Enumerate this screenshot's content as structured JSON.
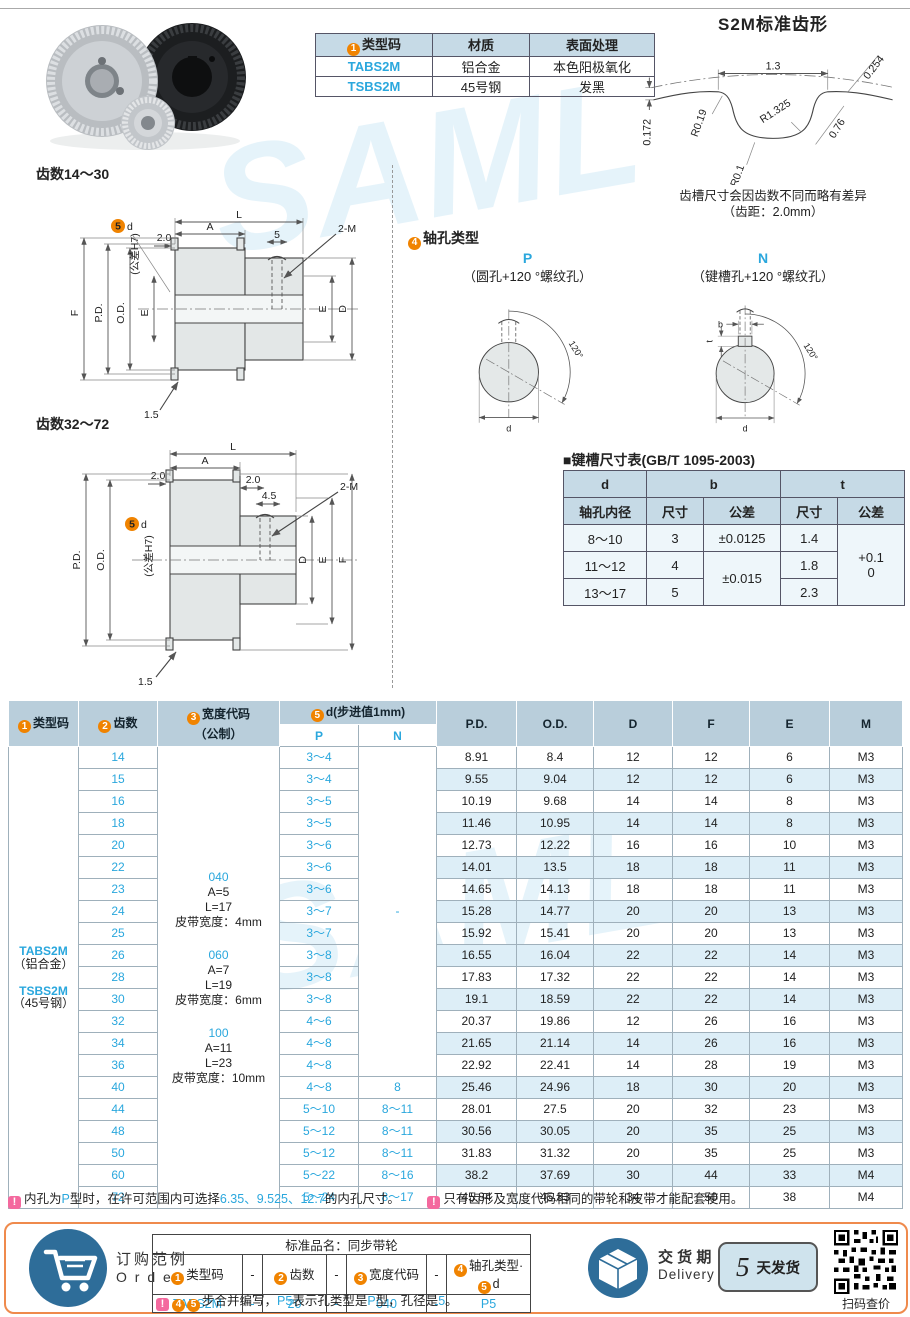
{
  "page": {
    "watermark": "SAML"
  },
  "top": {
    "type_table": {
      "badge": "1",
      "h_code": "类型码",
      "h_mat": "材质",
      "h_fin": "表面处理",
      "rows": [
        {
          "code": "TABS2M",
          "mat": "铝合金",
          "fin": "本色阳极氧化"
        },
        {
          "code": "TSBS2M",
          "mat": "45号钢",
          "fin": "发黑"
        }
      ]
    },
    "tooth_profile": {
      "title": "S2M标准齿形",
      "w": "1.3",
      "t254": "0.254",
      "r1": "R1.325",
      "r19": "R0.19",
      "f76": "0.76",
      "h172": "0.172",
      "r01": "R0.1",
      "note1": "齿槽尺寸会因齿数不同而略有差异",
      "note2": "（齿距：2.0mm）"
    }
  },
  "drawings": {
    "small": {
      "title": "齿数14～30",
      "l": "L",
      "a": "A",
      "off": "2.0",
      "s5": "5",
      "m": "2-M",
      "f": "F",
      "pd": "P.D.",
      "od": "O.D.",
      "e": "E",
      "e2": "E",
      "dd": "D",
      "fl": "1.5",
      "badge": "5",
      "d": "d",
      "tol": "(公差H7)"
    },
    "large": {
      "title": "齿数32～72",
      "l": "L",
      "a": "A",
      "off_l": "2.0",
      "off_r": "2.0",
      "s45": "4.5",
      "m": "2-M",
      "pd": "P.D.",
      "od": "O.D.",
      "dd": "D",
      "e": "E",
      "f": "F",
      "fl": "1.5",
      "badge": "5",
      "d": "d",
      "tol": "(公差H7)"
    }
  },
  "shaft_hole": {
    "badge": "4",
    "title": "轴孔类型",
    "p": {
      "label": "P",
      "desc": "（圆孔+120 °螺纹孔）",
      "angle": "120°",
      "d": "d"
    },
    "n": {
      "label": "N",
      "desc": "（键槽孔+120 °螺纹孔）",
      "angle": "120°",
      "d": "d",
      "b": "b",
      "t": "t"
    }
  },
  "keyway": {
    "title": "■键槽尺寸表(GB/T 1095-2003)",
    "h_d": "d",
    "h_d2": "轴孔内径",
    "h_b": "b",
    "h_t": "t",
    "h_size": "尺寸",
    "h_tol": "公差",
    "h_size2": "尺寸",
    "h_tol2": "公差",
    "rows": [
      {
        "d": "8～10",
        "b": "3",
        "bt": "±0.0125",
        "t": "1.4"
      },
      {
        "d": "11～12",
        "b": "4",
        "bt": "±0.015",
        "t": "1.8"
      },
      {
        "d": "13～17",
        "b": "5",
        "t": "2.3"
      }
    ],
    "t_tol1": "+0.1",
    "t_tol2": "0"
  },
  "main_table": {
    "header": {
      "b1": "1",
      "c1": "类型码",
      "b2": "2",
      "c2": "齿数",
      "b3": "3",
      "c3": "宽度代码",
      "c3b": "（公制）",
      "b5": "5",
      "c5": "d(步进值1mm)",
      "p": "P",
      "n": "N",
      "pd": "P.D.",
      "od": "O.D.",
      "d": "D",
      "f": "F",
      "e": "E",
      "m": "M"
    },
    "type_cell": {
      "code1": "TABS2M",
      "mat1": "（铝合金）",
      "code2": "TSBS2M",
      "mat2": "（45号钢）"
    },
    "width_groups": [
      {
        "code": "040",
        "a": "A=5",
        "l": "L=17",
        "belt": "皮带宽度：4mm"
      },
      {
        "code": "060",
        "a": "A=7",
        "l": "L=19",
        "belt": "皮带宽度：6mm"
      },
      {
        "code": "100",
        "a": "A=11",
        "l": "L=23",
        "belt": "皮带宽度：10mm"
      }
    ],
    "n_merged": "-",
    "rows": [
      {
        "t": "14",
        "p": "3～4",
        "pd": "8.91",
        "od": "8.4",
        "d": "12",
        "f": "12",
        "e": "6",
        "m": "M3"
      },
      {
        "t": "15",
        "p": "3～4",
        "pd": "9.55",
        "od": "9.04",
        "d": "12",
        "f": "12",
        "e": "6",
        "m": "M3"
      },
      {
        "t": "16",
        "p": "3～5",
        "pd": "10.19",
        "od": "9.68",
        "d": "14",
        "f": "14",
        "e": "8",
        "m": "M3"
      },
      {
        "t": "18",
        "p": "3～5",
        "pd": "11.46",
        "od": "10.95",
        "d": "14",
        "f": "14",
        "e": "8",
        "m": "M3"
      },
      {
        "t": "20",
        "p": "3～6",
        "pd": "12.73",
        "od": "12.22",
        "d": "16",
        "f": "16",
        "e": "10",
        "m": "M3"
      },
      {
        "t": "22",
        "p": "3～6",
        "pd": "14.01",
        "od": "13.5",
        "d": "18",
        "f": "18",
        "e": "11",
        "m": "M3"
      },
      {
        "t": "23",
        "p": "3～6",
        "pd": "14.65",
        "od": "14.13",
        "d": "18",
        "f": "18",
        "e": "11",
        "m": "M3"
      },
      {
        "t": "24",
        "p": "3～7",
        "pd": "15.28",
        "od": "14.77",
        "d": "20",
        "f": "20",
        "e": "13",
        "m": "M3"
      },
      {
        "t": "25",
        "p": "3～7",
        "pd": "15.92",
        "od": "15.41",
        "d": "20",
        "f": "20",
        "e": "13",
        "m": "M3"
      },
      {
        "t": "26",
        "p": "3～8",
        "pd": "16.55",
        "od": "16.04",
        "d": "22",
        "f": "22",
        "e": "14",
        "m": "M3"
      },
      {
        "t": "28",
        "p": "3～8",
        "pd": "17.83",
        "od": "17.32",
        "d": "22",
        "f": "22",
        "e": "14",
        "m": "M3"
      },
      {
        "t": "30",
        "p": "3～8",
        "pd": "19.1",
        "od": "18.59",
        "d": "22",
        "f": "22",
        "e": "14",
        "m": "M3"
      },
      {
        "t": "32",
        "p": "4～6",
        "pd": "20.37",
        "od": "19.86",
        "d": "12",
        "f": "26",
        "e": "16",
        "m": "M3"
      },
      {
        "t": "34",
        "p": "4～8",
        "pd": "21.65",
        "od": "21.14",
        "d": "14",
        "f": "26",
        "e": "16",
        "m": "M3"
      },
      {
        "t": "36",
        "p": "4～8",
        "pd": "22.92",
        "od": "22.41",
        "d": "14",
        "f": "28",
        "e": "19",
        "m": "M3"
      },
      {
        "t": "40",
        "p": "4～8",
        "n": "8",
        "pd": "25.46",
        "od": "24.96",
        "d": "18",
        "f": "30",
        "e": "20",
        "m": "M3"
      },
      {
        "t": "44",
        "p": "5～10",
        "n": "8～11",
        "pd": "28.01",
        "od": "27.5",
        "d": "20",
        "f": "32",
        "e": "23",
        "m": "M3"
      },
      {
        "t": "48",
        "p": "5～12",
        "n": "8～11",
        "pd": "30.56",
        "od": "30.05",
        "d": "20",
        "f": "35",
        "e": "25",
        "m": "M3"
      },
      {
        "t": "50",
        "p": "5～12",
        "n": "8～11",
        "pd": "31.83",
        "od": "31.32",
        "d": "20",
        "f": "35",
        "e": "25",
        "m": "M3"
      },
      {
        "t": "60",
        "p": "5～22",
        "n": "8～16",
        "pd": "38.2",
        "od": "37.69",
        "d": "30",
        "f": "44",
        "e": "33",
        "m": "M4"
      },
      {
        "t": "72",
        "p": "5～24",
        "n": "8～17",
        "pd": "45.84",
        "od": "45.33",
        "d": "34",
        "f": "50",
        "e": "38",
        "m": "M4"
      }
    ]
  },
  "notes": {
    "mark": "!",
    "n1a": "内孔为",
    "n1b": "P",
    "n1c": "型时，在许可范围内可选择",
    "n1d": "6.35、9.525、12.7",
    "n1e": "的内孔尺寸。",
    "n2": "只有齿形及宽度代码相同的带轮和皮带才能配套使用。"
  },
  "order": {
    "label_cn": "订购范例",
    "label_en": "O r d e r",
    "table_title": "标准品名：同步带轮",
    "b1": "1",
    "c1": "类型码",
    "b2": "2",
    "c2": "齿数",
    "b3": "3",
    "c3": "宽度代码",
    "b4": "4",
    "c4": "轴孔类型·",
    "b5": "5",
    "c5": "d",
    "dash": "-",
    "v1": "TABS2M",
    "v2": "20",
    "v3": "040",
    "v4": "P5",
    "mark": "!",
    "nb4": "4",
    "nb5": "5",
    "n1": "步合并编写，",
    "n2": "P5",
    "n3": "表示孔类型是",
    "n4": "P",
    "n5": "型，孔径是",
    "n6": "5",
    "n7": "。"
  },
  "delivery": {
    "label_cn": "交 货 期",
    "label_en": "Delivery",
    "days": "5",
    "unit": "天发货",
    "qr_caption": "扫码查价"
  }
}
